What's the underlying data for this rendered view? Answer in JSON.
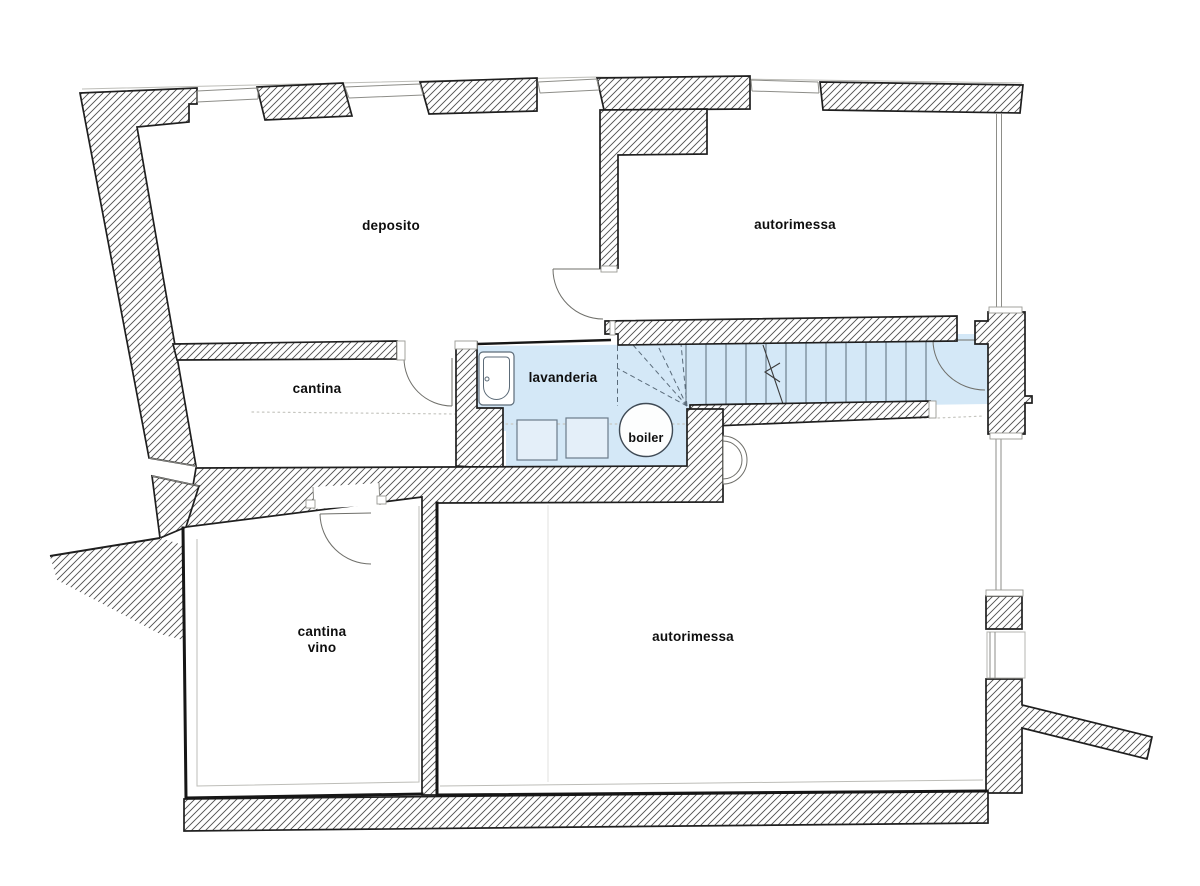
{
  "plan": {
    "rooms": [
      {
        "id": "deposito",
        "label": "deposito"
      },
      {
        "id": "autorimessa-top",
        "label": "autorimessa"
      },
      {
        "id": "cantina",
        "label": "cantina"
      },
      {
        "id": "lavanderia",
        "label": "lavanderia"
      },
      {
        "id": "boiler",
        "label": "boiler"
      },
      {
        "id": "cantina-vino",
        "label": "cantina vino",
        "line1": "cantina",
        "line2": "vino"
      },
      {
        "id": "autorimessa-bottom",
        "label": "autorimessa"
      }
    ],
    "colors": {
      "highlight": "#d4e8f7",
      "wall_outline": "#1f1f1f",
      "hatch": "#4e4e4e",
      "fixture_outline": "#5c6b78"
    }
  }
}
